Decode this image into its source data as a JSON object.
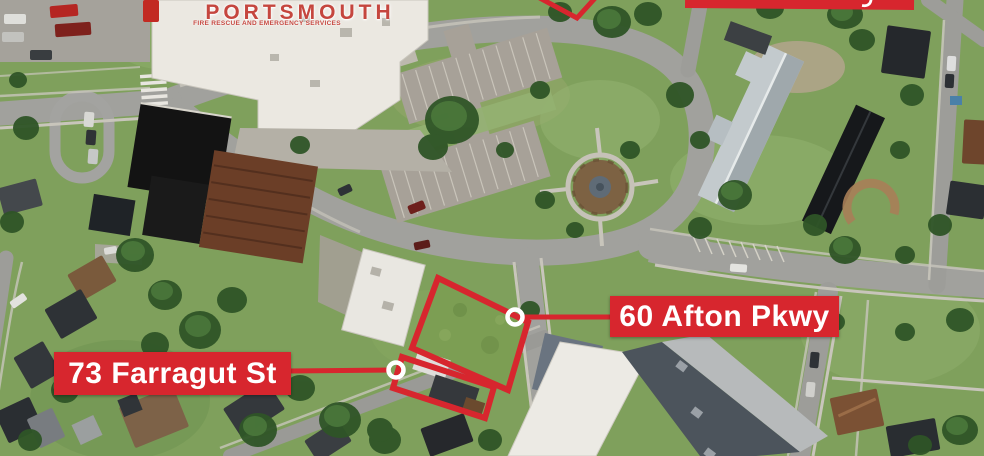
{
  "logo": {
    "title": "PORTSMOUTH",
    "subtitle": "FIRE RESCUE AND EMERGENCY SERVICES"
  },
  "labels": {
    "afton": {
      "text": "60 Afton Pkwy"
    },
    "farragut": {
      "text": "73 Farragut St"
    }
  },
  "markers": {
    "afton": {
      "shape": "white-ring"
    },
    "farragut": {
      "shape": "white-ring"
    }
  },
  "partial_annotations": {
    "top_center_parcel_outline_cut": true,
    "top_right_label_bar_cut": true
  },
  "colors": {
    "annotation_red": "#d7262e",
    "label_text": "#ffffff",
    "logo_red": "#c5463e",
    "marker_ring": "#ffffff"
  }
}
